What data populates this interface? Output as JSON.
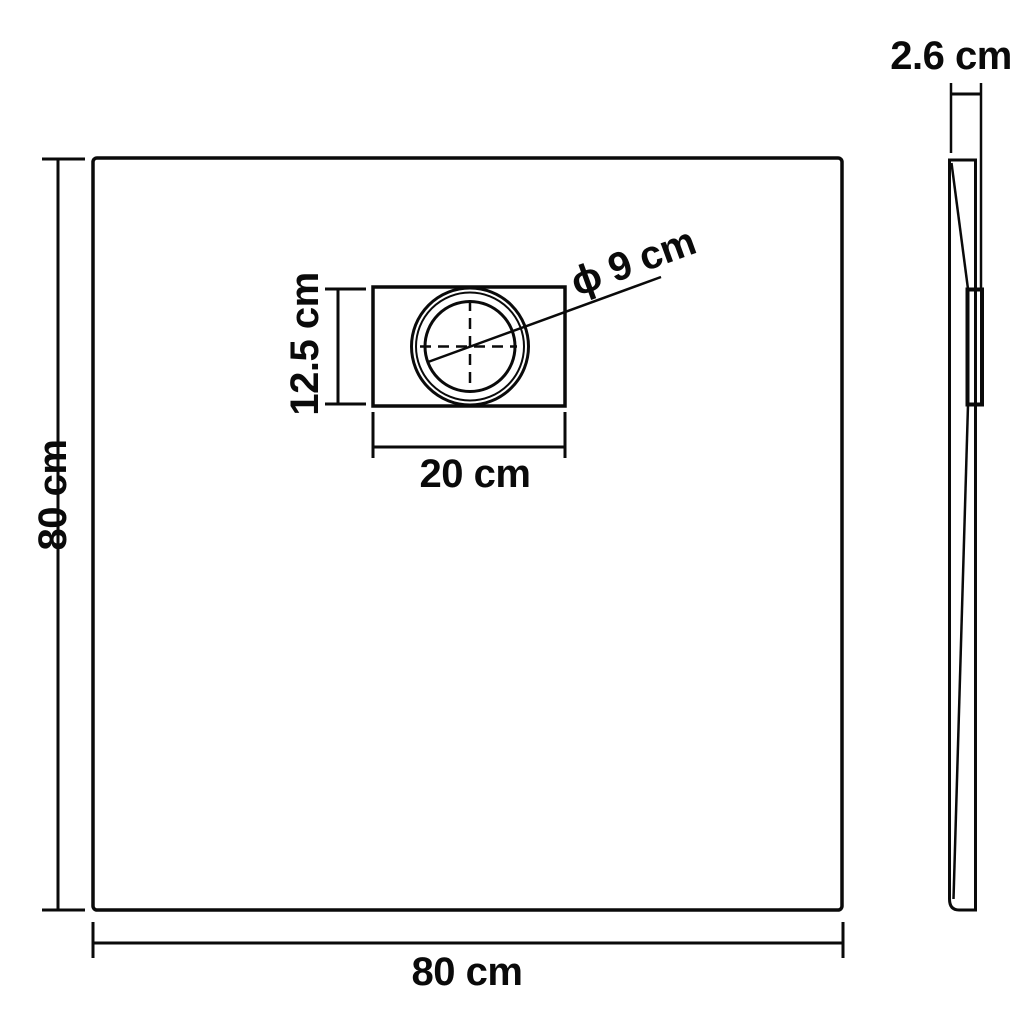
{
  "diagram": {
    "product": "Square shower tray technical drawing",
    "line_color": "#0a0a0a",
    "background_color": "#ffffff",
    "top_view": {
      "width_label": "80 cm",
      "height_label": "80 cm",
      "drain": {
        "width_label": "20 cm",
        "height_label": "12.5 cm",
        "diameter_label": "ϕ 9 cm"
      }
    },
    "side_view": {
      "thickness_label": "2.6 cm"
    }
  }
}
